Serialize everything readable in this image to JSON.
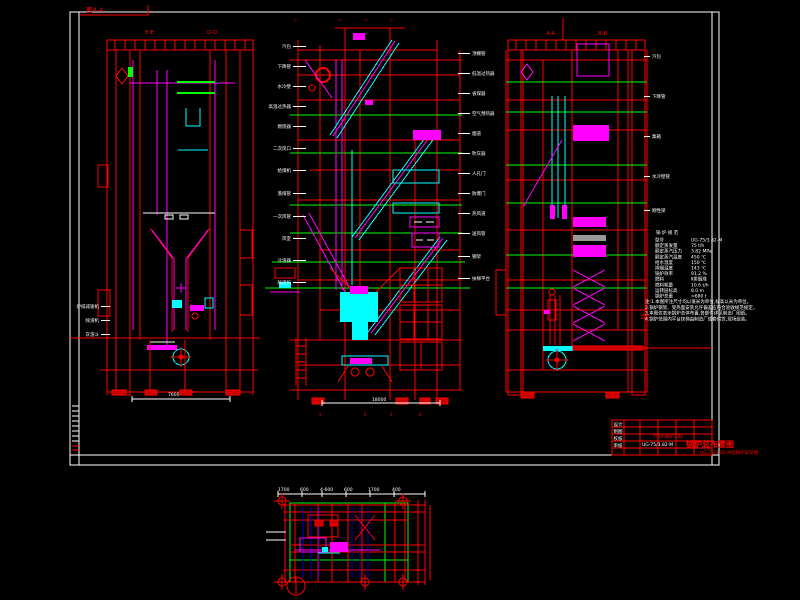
{
  "page": {
    "bg": "#000000"
  },
  "figure_label": "图4-4",
  "sections": {
    "left_view": [
      "E-E",
      "D-D"
    ],
    "right_view": [
      "A-A",
      "B-B"
    ]
  },
  "elevation_marks": [
    "▽",
    "▽",
    "▽",
    "▽"
  ],
  "axis_labels": [
    "1",
    "2",
    "3",
    "4"
  ],
  "dimensions": {
    "left_view_width": "7600",
    "middle_view_width": "18000",
    "plan_segments": [
      "1700",
      "600",
      "4-600",
      "600",
      "1700",
      "400"
    ]
  },
  "callouts": {
    "middle_left": [
      "汽包",
      "下降管",
      "水冷壁",
      "高温过热器",
      "燃烧器",
      "二次风口",
      "给煤机",
      "落煤管",
      "一次风管",
      "风室",
      "冷渣器",
      "除渣机"
    ],
    "middle_right": [
      "顶棚管",
      "低温过热器",
      "省煤器",
      "空气预热器",
      "烟道",
      "吹灰器",
      "人孔门",
      "防爆门",
      "热风道",
      "送风管",
      "钢架",
      "扶梯平台"
    ],
    "left_view": [
      "炉排减速机",
      "除渣机",
      "灰渣斗"
    ],
    "right_view": [
      "汽包",
      "下降管",
      "集箱",
      "水冷壁管",
      "刚性梁"
    ]
  },
  "spec_table": {
    "title": "锅 炉 规 范",
    "rows": [
      [
        "型号",
        "UG-75/3.82-M"
      ],
      [
        "额定蒸发量",
        "75 t/h"
      ],
      [
        "额定蒸汽压力",
        "3.82 MPa"
      ],
      [
        "额定蒸汽温度",
        "450 ℃"
      ],
      [
        "给水温度",
        "150 ℃"
      ],
      [
        "排烟温度",
        "143 ℃"
      ],
      [
        "锅炉效率",
        "91.2 %"
      ],
      [
        "燃料",
        "Ⅱ类烟煤"
      ],
      [
        "燃料耗量",
        "10.6 t/h"
      ],
      [
        "运转层标高",
        "8.0 m"
      ],
      [
        "锅炉总重",
        "≈680 t"
      ]
    ]
  },
  "notes": [
    "注:1.本图所注尺寸均以毫米为单位,标高以米为单位。",
    "2.锅炉钢架、受热面安装允许偏差应符合验收规范规定。",
    "3.本图仅表示锅炉总体布置,各部件详见制造厂图纸。",
    "4.锅炉范围内平台扶梯由制造厂成套供货,现场组装。"
  ],
  "title_block": {
    "cells": [
      "设计",
      "制图",
      "校核",
      "审核"
    ],
    "project": "75t/h锅炉工程",
    "model": "UG-75/3.82-M",
    "drawing_title": "锅炉总布置图",
    "drawing_subtitle": "UG-75/3.82-M型锅炉安装图"
  }
}
